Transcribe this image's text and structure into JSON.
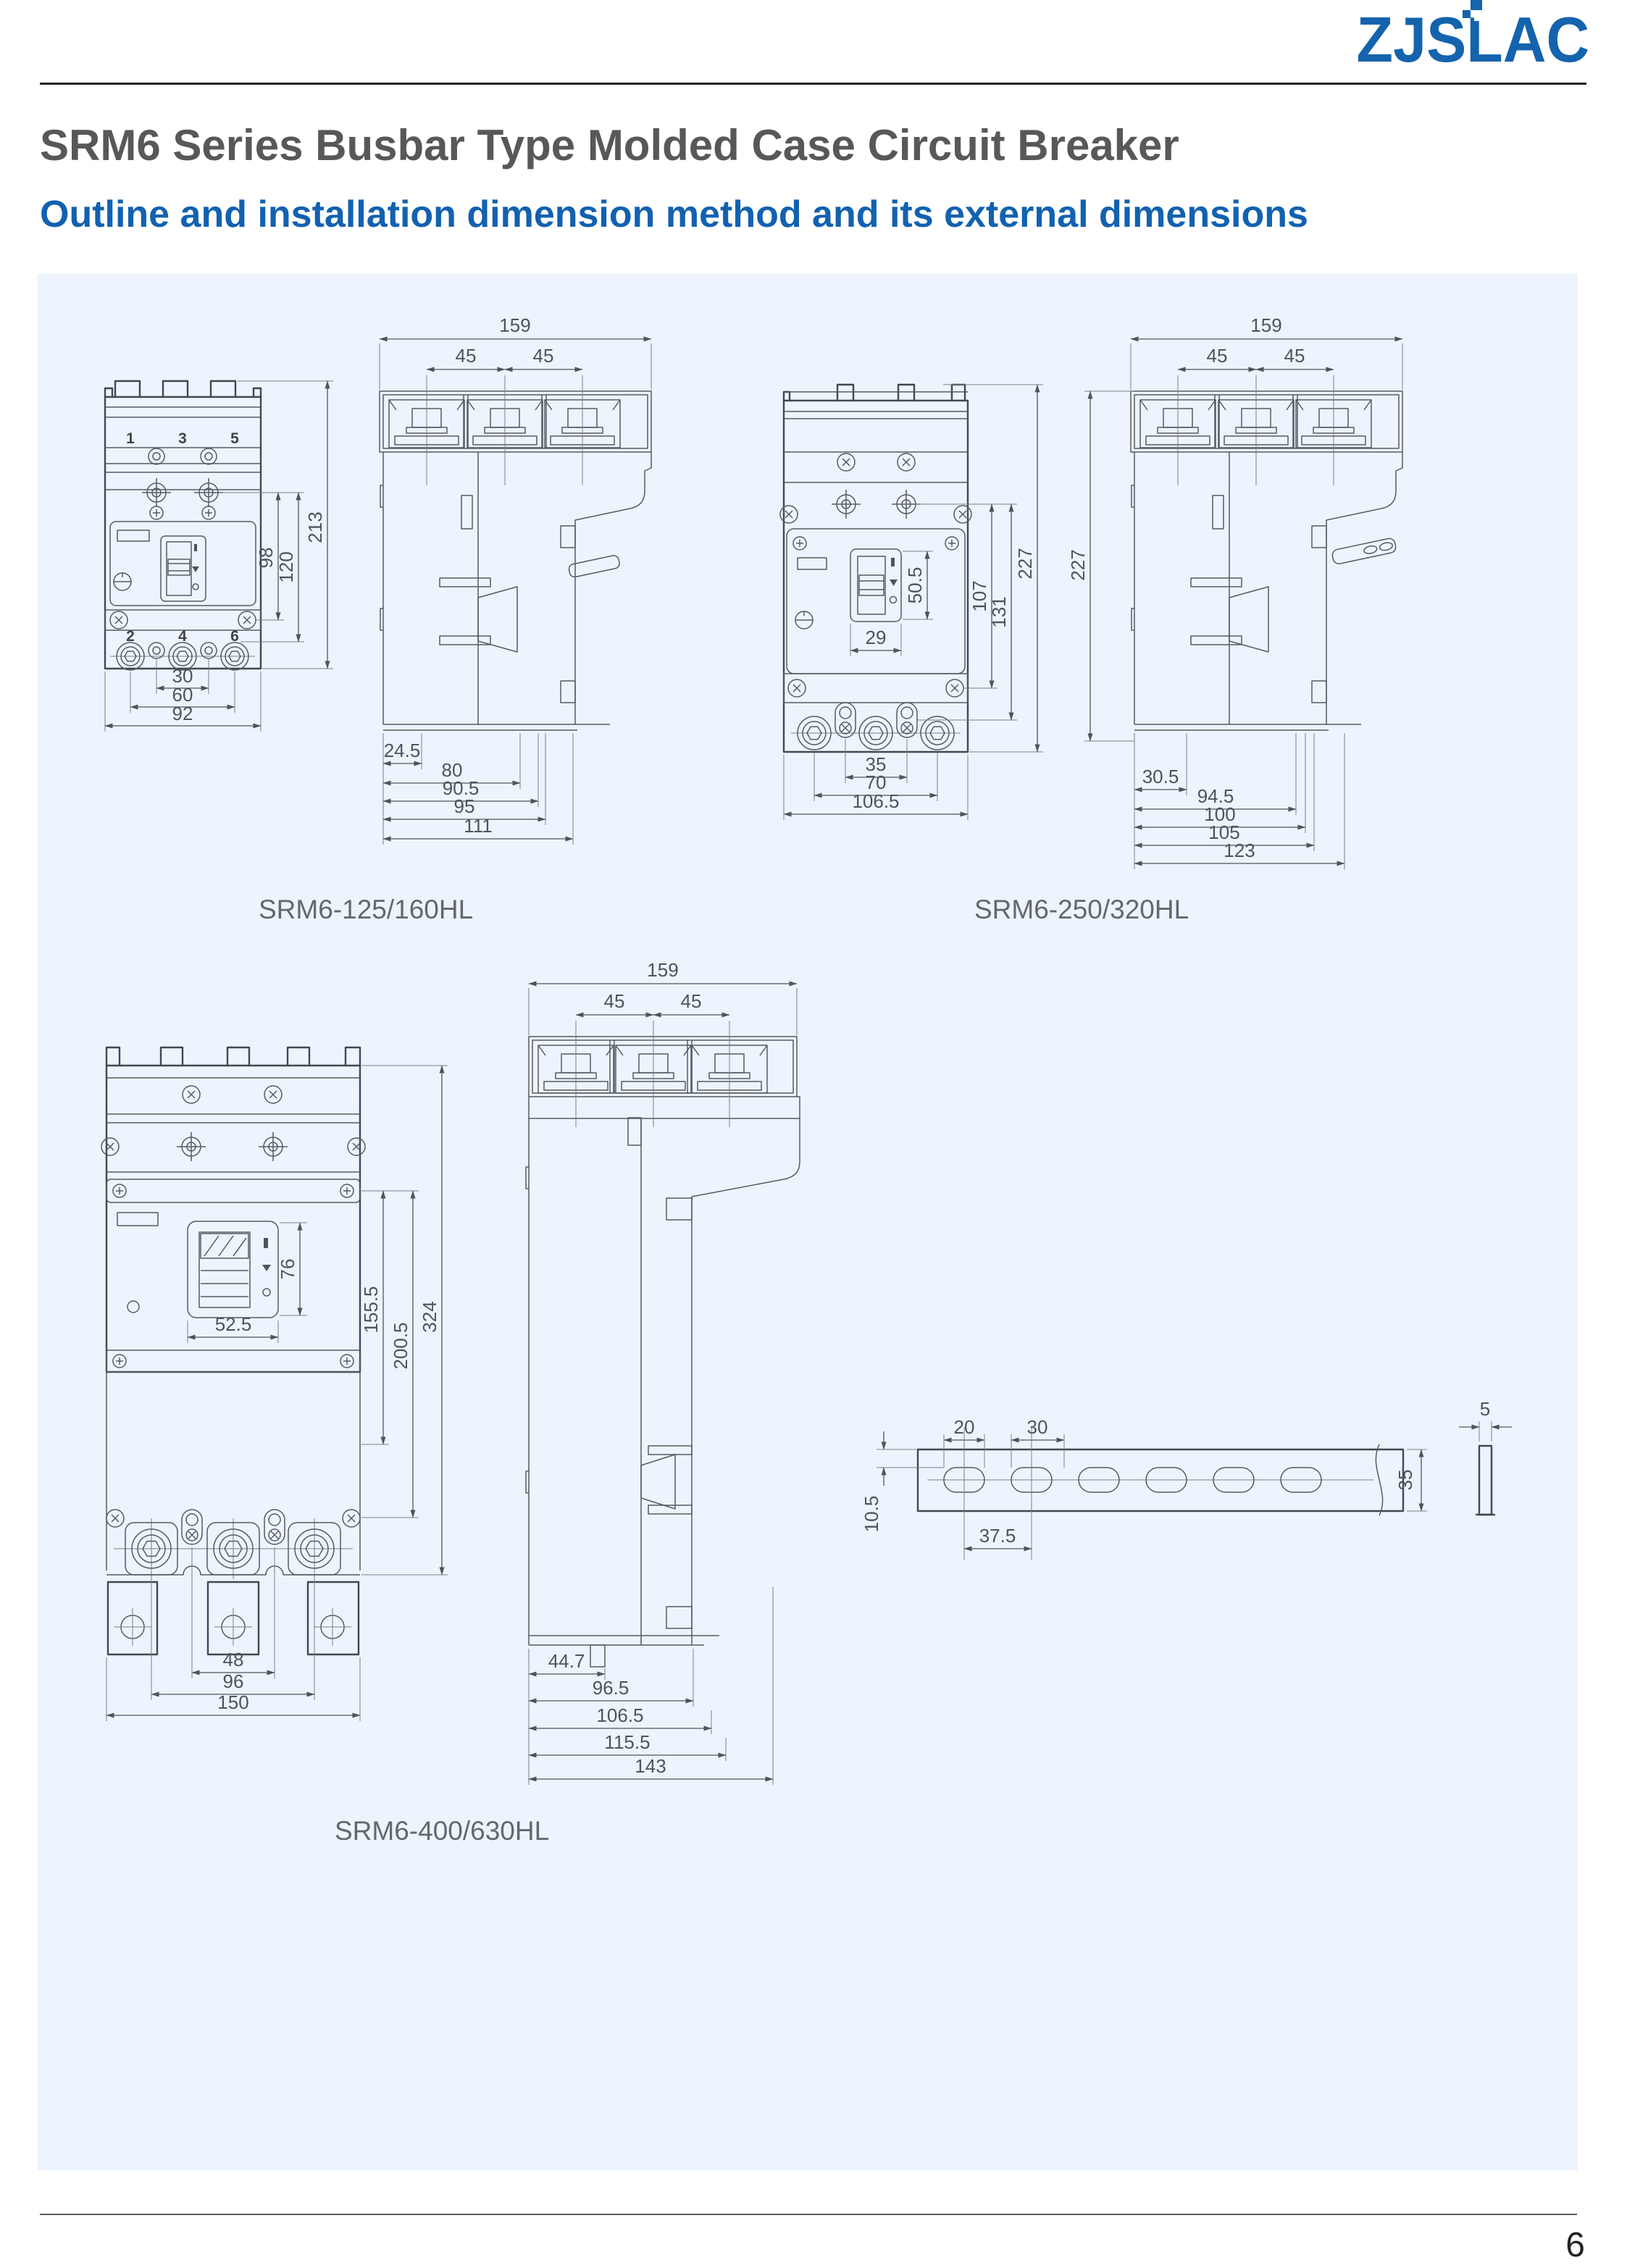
{
  "brand": {
    "logo_text": "ZJSLAC"
  },
  "page": {
    "title": "SRM6 Series Busbar Type Molded Case Circuit Breaker",
    "subtitle": "Outline and installation dimension method and its external dimensions",
    "page_number": "6"
  },
  "colors": {
    "brand_blue": "#1463ad",
    "subtitle_blue": "#1261b0",
    "title_gray": "#57585a",
    "panel_bg": "#edf4fd",
    "drawing_stroke": "#43484d",
    "dimension_text": "#4f545a",
    "caption_gray": "#63686c"
  },
  "fig1": {
    "caption": "SRM6-125/160HL",
    "front": {
      "pole1": "1",
      "pole3": "3",
      "pole5": "5",
      "pole2": "2",
      "pole4": "4",
      "pole6": "6",
      "overall_height": "213",
      "mount_height_inner": "98",
      "mount_height_outer": "120",
      "terminal_pitch": "30",
      "terminal_span": "60",
      "overall_width": "92"
    },
    "side": {
      "overall_width": "159",
      "pole_pitch_left": "45",
      "pole_pitch_right": "45",
      "depth_a": "24.5",
      "depth_b": "80",
      "depth_c": "90.5",
      "depth_d": "95",
      "depth_e": "111"
    }
  },
  "fig2": {
    "caption": "SRM6-250/320HL",
    "front": {
      "overall_height": "227",
      "handle_height": "50.5",
      "mount_height_inner": "107",
      "mount_height_outer": "131",
      "handle_width": "29",
      "terminal_pitch": "35",
      "terminal_span": "70",
      "overall_width": "106.5"
    },
    "side": {
      "overall_width": "159",
      "pole_pitch_left": "45",
      "pole_pitch_right": "45",
      "overall_height": "227",
      "depth_a": "30.5",
      "depth_b": "94.5",
      "depth_c": "100",
      "depth_d": "105",
      "depth_e": "123"
    }
  },
  "fig3": {
    "caption": "SRM6-400/630HL",
    "front": {
      "overall_height": "324",
      "mount_height_inner": "155.5",
      "mount_height_outer": "200.5",
      "handle_height": "76",
      "handle_width": "52.5",
      "terminal_pitch": "48",
      "terminal_span": "96",
      "overall_width": "150"
    },
    "side": {
      "overall_width": "159",
      "pole_pitch_left": "45",
      "pole_pitch_right": "45",
      "depth_a": "44.7",
      "depth_b": "96.5",
      "depth_c": "106.5",
      "depth_d": "115.5",
      "depth_e": "143"
    }
  },
  "busbar": {
    "slot_length": "20",
    "slot_gap": "30",
    "hole_pitch": "37.5",
    "edge_offset": "10.5",
    "bar_width": "35",
    "bar_thickness": "5"
  }
}
